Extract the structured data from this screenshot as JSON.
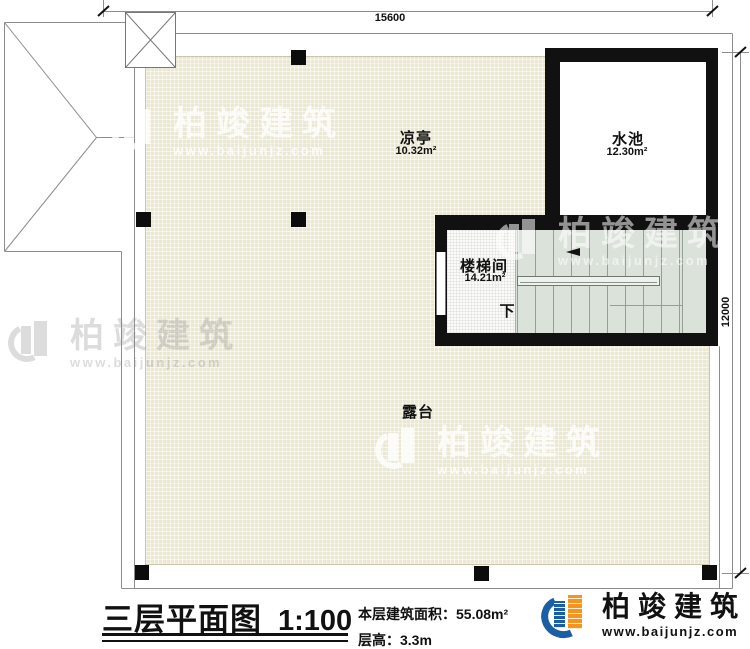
{
  "plan": {
    "dimensions": {
      "top": "15600",
      "right": "12000"
    },
    "rooms": {
      "pavilion": {
        "name": "凉亭",
        "area": "10.32m²"
      },
      "pool": {
        "name": "水池",
        "area": "12.30m²"
      },
      "stairwell": {
        "name": "楼梯间",
        "area": "14.21m²"
      },
      "terrace": {
        "name": "露台"
      }
    },
    "stairs": {
      "direction": "下"
    }
  },
  "title_block": {
    "title": "三层平面图",
    "scale": "1:100",
    "area_label": "本层建筑面积：",
    "area_value": "55.08m²",
    "height_label": "层高：",
    "height_value": "3.3m"
  },
  "branding": {
    "company": "柏竣建筑",
    "website": "www.baijunjz.com"
  },
  "watermark": {
    "company": "柏竣建筑",
    "website": "www.baijunjz.com"
  },
  "colors": {
    "terrace": "#eae7d3",
    "stairs": "#dbe2da",
    "wall": "#111111",
    "logo_blue": "#1b5ea6",
    "logo_orange": "#f7941e"
  }
}
